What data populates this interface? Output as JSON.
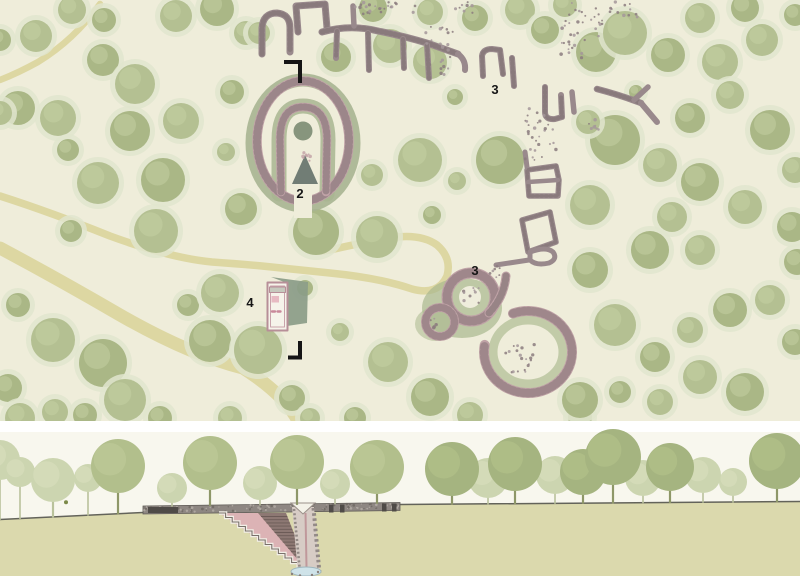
{
  "colors": {
    "plan_bg": "#efedda",
    "path_tan": "#ddd7a2",
    "tree_halo": "#e0e5ce",
    "tree_fill_a": "#b4c092",
    "tree_fill_b": "#aab786",
    "tree_light": "#c6d1a4",
    "stone_grey": "#99898c",
    "stone_pink": "#bfa2a6",
    "stipple_dark": "#7e6f72",
    "label_ink": "#161616",
    "marker_ink": "#151515",
    "section_sky": "#f8f7ee",
    "section_ground": "#dbd9ad",
    "ground_line": "#63635a",
    "cairn_grey": "#8e8782",
    "cairn_dark": "#4f4b47",
    "stair_pink": "#dcb3b5",
    "brick_wall": "#8d7873",
    "brick_line": "#6c5b57",
    "shaft_fill": "#d7ccc5",
    "shaft_stipple": "#938a86",
    "water_blue": "#cfe3e9",
    "figure_olive": "#7c8a49",
    "trunk_dark": "#8e9768",
    "trunk_light": "#b9c29b",
    "canopy_d": "#a5b480",
    "canopy_m": "#b2bf8c",
    "canopy_l": "#ccd5b0"
  },
  "plan": {
    "labels": [
      {
        "t": "2",
        "x": 300,
        "y": 198
      },
      {
        "t": "3",
        "x": 495,
        "y": 94
      },
      {
        "t": "3",
        "x": 475,
        "y": 275
      },
      {
        "t": "4",
        "x": 250,
        "y": 307
      }
    ],
    "markers": [
      "M284,62 L300,62 L300,83",
      "M288,357.5 L300,357.5 L300,341"
    ],
    "paths": [
      {
        "d": "M100,4 Q74,40 38,62 Q18,73 0,80",
        "w": 6.5
      },
      {
        "d": "M0,248 Q60,280 120,315 Q190,355 243,368 Q285,395 298,421",
        "w": 13
      },
      {
        "d": "M0,196 Q50,212 110,236 Q170,258 212,262 Q240,264 262,266 Q300,270 330,273 Q380,278 412,289 Q438,296 447,276 Q452,258 437,245 Q420,233 390,238 Q355,244 330,250 Q310,254 303,242 Q298,232 301,213",
        "w": 7.5
      }
    ],
    "trees": [
      [
        36,
        36,
        16
      ],
      [
        0,
        40,
        11
      ],
      [
        72,
        10,
        14
      ],
      [
        104,
        20,
        12
      ],
      [
        176,
        16,
        16
      ],
      [
        217,
        9,
        17
      ],
      [
        246,
        33,
        12
      ],
      [
        103,
        60,
        16
      ],
      [
        135,
        84,
        20
      ],
      [
        18,
        108,
        17
      ],
      [
        58,
        118,
        18
      ],
      [
        130,
        131,
        20
      ],
      [
        181,
        121,
        18
      ],
      [
        68,
        150,
        11
      ],
      [
        98,
        183,
        21
      ],
      [
        163,
        180,
        22
      ],
      [
        0,
        113,
        12
      ],
      [
        71,
        231,
        11
      ],
      [
        156,
        231,
        22
      ],
      [
        18,
        305,
        12
      ],
      [
        53,
        340,
        22
      ],
      [
        103,
        363,
        24
      ],
      [
        125,
        400,
        21
      ],
      [
        8,
        388,
        14
      ],
      [
        55,
        412,
        13
      ],
      [
        188,
        305,
        11
      ],
      [
        220,
        293,
        19
      ],
      [
        210,
        341,
        21
      ],
      [
        20,
        418,
        15
      ],
      [
        85,
        415,
        12
      ],
      [
        258,
        350,
        24
      ],
      [
        292,
        398,
        13
      ],
      [
        230,
        418,
        12
      ],
      [
        160,
        418,
        12
      ],
      [
        310,
        418,
        10
      ],
      [
        232,
        92,
        12
      ],
      [
        226,
        152,
        9
      ],
      [
        241,
        209,
        16
      ],
      [
        372,
        175,
        11
      ],
      [
        316,
        232,
        23
      ],
      [
        377,
        237,
        21
      ],
      [
        305,
        288,
        8
      ],
      [
        259,
        33,
        11
      ],
      [
        336,
        57,
        15
      ],
      [
        390,
        46,
        17
      ],
      [
        373,
        8,
        14
      ],
      [
        430,
        12,
        13
      ],
      [
        475,
        18,
        13
      ],
      [
        520,
        10,
        15
      ],
      [
        545,
        30,
        14
      ],
      [
        430,
        62,
        17
      ],
      [
        455,
        97,
        8
      ],
      [
        420,
        160,
        22
      ],
      [
        500,
        160,
        24
      ],
      [
        457,
        181,
        9
      ],
      [
        432,
        215,
        9
      ],
      [
        565,
        5,
        12
      ],
      [
        596,
        52,
        20
      ],
      [
        625,
        33,
        22
      ],
      [
        668,
        55,
        17
      ],
      [
        700,
        18,
        15
      ],
      [
        745,
        8,
        14
      ],
      [
        762,
        40,
        16
      ],
      [
        795,
        15,
        11
      ],
      [
        720,
        62,
        18
      ],
      [
        615,
        140,
        25
      ],
      [
        660,
        165,
        17
      ],
      [
        690,
        118,
        15
      ],
      [
        730,
        95,
        14
      ],
      [
        770,
        130,
        20
      ],
      [
        795,
        170,
        13
      ],
      [
        700,
        182,
        19
      ],
      [
        745,
        207,
        17
      ],
      [
        792,
        227,
        15
      ],
      [
        672,
        217,
        15
      ],
      [
        636,
        92,
        7
      ],
      [
        588,
        122,
        12
      ],
      [
        797,
        262,
        13
      ],
      [
        590,
        205,
        20
      ],
      [
        650,
        250,
        19
      ],
      [
        700,
        250,
        15
      ],
      [
        590,
        270,
        18
      ],
      [
        615,
        325,
        21
      ],
      [
        655,
        357,
        15
      ],
      [
        690,
        330,
        13
      ],
      [
        730,
        310,
        17
      ],
      [
        770,
        300,
        15
      ],
      [
        795,
        342,
        13
      ],
      [
        700,
        377,
        17
      ],
      [
        745,
        392,
        19
      ],
      [
        660,
        402,
        13
      ],
      [
        620,
        392,
        11
      ],
      [
        580,
        417,
        12
      ],
      [
        580,
        400,
        18
      ],
      [
        388,
        362,
        20
      ],
      [
        430,
        397,
        19
      ],
      [
        470,
        415,
        13
      ],
      [
        355,
        418,
        11
      ],
      [
        340,
        332,
        9
      ]
    ],
    "shapes": [
      {
        "t": "p",
        "d": "M262,54 L262,28 Q263,13 277,13 Q290,14 290,28 L290,52",
        "s": "#99898c",
        "w": 7,
        "tex": 1
      },
      {
        "t": "p",
        "d": "M298,32 L296,6 L325,4 L327,28",
        "s": "#99898c",
        "w": 7,
        "tex": 1
      },
      {
        "t": "p",
        "d": "M322,32 Q350,24 378,31 Q404,36 430,44 L458,54",
        "s": "#99898c",
        "w": 7,
        "tex": 1
      },
      {
        "t": "p",
        "d": "M337,31 L336,58",
        "s": "#99898c",
        "w": 6,
        "tex": 1
      },
      {
        "t": "p",
        "d": "M368,33 L369,70",
        "s": "#99898c",
        "w": 6,
        "tex": 1
      },
      {
        "t": "p",
        "d": "M403,39 L404,68",
        "s": "#99898c",
        "w": 6,
        "tex": 1
      },
      {
        "t": "p",
        "d": "M427,45 L429,78",
        "s": "#99898c",
        "w": 6,
        "tex": 1
      },
      {
        "t": "p",
        "d": "M354,26 L353,6",
        "s": "#99898c",
        "w": 5.5
      },
      {
        "t": "p",
        "d": "M458,54 Q466,60 465,70",
        "s": "#99898c",
        "w": 6
      },
      {
        "t": "p",
        "d": "M483,76 L482,56 Q483,49 492,49 L500,50 L503,74",
        "s": "#99898c",
        "w": 6,
        "tex": 1
      },
      {
        "t": "p",
        "d": "M512,58 L514,86",
        "s": "#99898c",
        "w": 6,
        "tex": 1
      },
      {
        "t": "p",
        "d": "M545,87 L545,112 Q545,120 555,119 L562,117 L561,95",
        "s": "#99898c",
        "w": 6,
        "tex": 1
      },
      {
        "t": "p",
        "d": "M572,92 L574,112",
        "s": "#99898c",
        "w": 5.5
      },
      {
        "t": "p",
        "d": "M597,89 Q620,95 641,103",
        "s": "#99898c",
        "w": 6.5,
        "tex": 1
      },
      {
        "t": "p",
        "d": "M641,103 L657,122",
        "s": "#99898c",
        "w": 6
      },
      {
        "t": "p",
        "d": "M634,100 L648,87",
        "s": "#99898c",
        "w": 5.5
      },
      {
        "t": "p",
        "d": "M525,152 L527,167",
        "s": "#99898c",
        "w": 5
      },
      {
        "t": "p",
        "d": "M529,196 L527,170 L556,166 L559,180 L558,196 Z",
        "s": "#99898c",
        "w": 5.5,
        "tex": 1
      },
      {
        "t": "p",
        "d": "M528,182 L558,180",
        "s": "#99898c",
        "w": 4.5
      },
      {
        "t": "p",
        "d": "M522,220 L550,212 L556,242 L528,252 Z",
        "s": "#99898c",
        "w": 5.5,
        "tex": 1
      },
      {
        "t": "p",
        "d": "M530,252 Q546,246 553,252 Q558,259 549,263 Q536,266 530,260 Z",
        "s": "#99898c",
        "w": 5
      },
      {
        "t": "p",
        "d": "M496,265 L529,260",
        "s": "#99898c",
        "w": 5
      },
      {
        "t": "e",
        "cx": 303,
        "cy": 143,
        "rx": 51,
        "ry": 63,
        "s": "#a7b491",
        "w": 13,
        "o": 0.9
      },
      {
        "t": "p",
        "d": "M279,194 L279,140 Q279,106 303,106 Q328,106 328,140 L327,194",
        "s": "#a8b591",
        "w": 15,
        "o": 0.85
      },
      {
        "t": "e",
        "cx": 303,
        "cy": 141,
        "rx": 46,
        "ry": 60,
        "s": "#c0a3a7",
        "w": 9.5
      },
      {
        "t": "e",
        "cx": 303,
        "cy": 141,
        "rx": 46,
        "ry": 60,
        "s": "#8d797d",
        "w": 8,
        "da": "1.6 3.4",
        "o": 0.7
      },
      {
        "t": "p",
        "d": "M294,192 h18 v26 h-18 Z",
        "f": "#efedda"
      },
      {
        "t": "p",
        "d": "M281,192 L280,140 Q280,107 303,107 Q327,107 327,140 L326,192",
        "s": "#c0a3a7",
        "w": 8.5
      },
      {
        "t": "p",
        "d": "M281,192 L280,140 Q280,107 303,107 Q327,107 327,140 L326,192",
        "s": "#8d797d",
        "w": 7,
        "da": "1.5 3",
        "o": 0.7
      },
      {
        "t": "c",
        "cx": 303,
        "cy": 131,
        "r": 9.5,
        "f": "#87957d"
      },
      {
        "t": "p",
        "d": "M305,155 L318,184 L292,184 Z",
        "f": "#717d75"
      },
      {
        "t": "e",
        "cx": 462,
        "cy": 308,
        "rx": 40,
        "ry": 30,
        "f": "#a9b88e",
        "o": 0.7
      },
      {
        "t": "e",
        "cx": 436,
        "cy": 324,
        "rx": 21,
        "ry": 17,
        "f": "#a9b88e",
        "o": 0.55
      },
      {
        "t": "c",
        "cx": 471,
        "cy": 297,
        "r": 24,
        "s": "#bfa2a6",
        "w": 11
      },
      {
        "t": "c",
        "cx": 471,
        "cy": 297,
        "r": 24,
        "s": "#8d797d",
        "w": 9,
        "da": "1.6 3.2",
        "o": 0.65
      },
      {
        "t": "c",
        "cx": 440,
        "cy": 322,
        "r": 14.5,
        "s": "#bfa2a6",
        "w": 9
      },
      {
        "t": "c",
        "cx": 440,
        "cy": 322,
        "r": 14.5,
        "s": "#8d797d",
        "w": 7.5,
        "da": "1.5 3",
        "o": 0.65
      },
      {
        "t": "c",
        "cx": 470,
        "cy": 297,
        "r": 11,
        "f": "#efeddc"
      },
      {
        "t": "p",
        "d": "M489,313 Q504,297 506,276",
        "s": "#bfa2a6",
        "w": 9,
        "tex": 1
      },
      {
        "t": "e",
        "cx": 528,
        "cy": 352,
        "rx": 35,
        "ry": 32,
        "s": "#a9b88e",
        "w": 9,
        "o": 0.65
      },
      {
        "t": "p",
        "d": "M513,313.5 A44,41 0 1 1 484.7,344.9",
        "s": "#bfa2a6",
        "w": 10
      },
      {
        "t": "p",
        "d": "M513,313.5 A44,41 0 1 1 484.7,344.9",
        "s": "#8d797d",
        "w": 8.5,
        "da": "1.7 3.4",
        "o": 0.65
      },
      {
        "t": "p",
        "d": "M271,277 L308,282 L307,323 L287,326 L287,283 Z",
        "f": "#8b9c88",
        "o": 0.92
      },
      {
        "t": "p",
        "d": "M267.5,282.5 h20 v48 h-20 Z",
        "f": "#f6f3ea",
        "s": "#b78f98",
        "w": 2
      },
      {
        "t": "p",
        "d": "M270.5,286 h14 v41 h-14 Z",
        "s": "#c9a3ab",
        "w": 1
      },
      {
        "t": "p",
        "d": "M269.5,287 h16 v5.5 h-16 Z",
        "f": "#c6c9bd",
        "s": "#b78f98",
        "w": 1
      },
      {
        "t": "p",
        "d": "M271.5,296 h7.5 v6.5 h-7.5 Z",
        "f": "#e7bac2"
      },
      {
        "t": "p",
        "d": "M272,311.5 h3 M277.5,311.5 h3",
        "s": "#c9889a",
        "w": 2.4
      }
    ],
    "rubble": [
      [
        352,
        2,
        66,
        12,
        24,
        0
      ],
      [
        425,
        25,
        35,
        50,
        26,
        0
      ],
      [
        556,
        2,
        48,
        36,
        26,
        0
      ],
      [
        610,
        2,
        32,
        20,
        12,
        0
      ],
      [
        525,
        108,
        32,
        52,
        30,
        0
      ],
      [
        455,
        2,
        18,
        12,
        8,
        0
      ],
      [
        560,
        40,
        26,
        18,
        12,
        0
      ],
      [
        585,
        118,
        16,
        12,
        7,
        0
      ],
      [
        462,
        288,
        17,
        15,
        9,
        0
      ],
      [
        505,
        342,
        30,
        32,
        20,
        0
      ],
      [
        486,
        266,
        14,
        12,
        7,
        0
      ],
      [
        300,
        152,
        14,
        16,
        8,
        1
      ],
      [
        428,
        316,
        12,
        12,
        6,
        0
      ]
    ]
  },
  "divider": {
    "y": 421,
    "h": 11
  },
  "section": {
    "groundPts": [
      [
        0,
        519.5
      ],
      [
        143,
        512.5
      ],
      [
        400,
        504.5
      ],
      [
        800,
        501.5
      ]
    ],
    "band": {
      "pts": [
        [
          143,
          514
        ],
        [
          143,
          506
        ],
        [
          400,
          502.5
        ],
        [
          400,
          510.5
        ]
      ],
      "topLeft": 506,
      "topRight": 502.5,
      "x0": 143,
      "x1": 400,
      "thick": 7.5,
      "speckles": 120,
      "blocks": [
        [
          148,
          507,
          30,
          6
        ],
        [
          329,
          504.5,
          4.5,
          8
        ],
        [
          340,
          504.5,
          4.5,
          8
        ],
        [
          382,
          503.5,
          4.5,
          8
        ],
        [
          392,
          503.5,
          4.5,
          8
        ]
      ]
    },
    "excavation": {
      "pink": [
        [
          219,
          513
        ],
        [
          286,
          513
        ],
        [
          310,
          574
        ]
      ],
      "brick": [
        [
          258,
          513
        ],
        [
          286,
          513
        ],
        [
          310,
          574
        ]
      ],
      "hatch": {
        "y0": 516.5,
        "y1": 571,
        "step": 3.2,
        "xl0": 258,
        "kl": 0.852,
        "xr0": 286,
        "kr": 0.393,
        "yb": 513
      },
      "steps": {
        "x": 219,
        "y": 513,
        "n": 13,
        "dx": 6.6,
        "dy": 4.5
      },
      "shaft": [
        [
          292,
          507
        ],
        [
          314,
          507
        ],
        [
          320,
          574
        ],
        [
          298,
          574
        ]
      ],
      "shaftEdges": [
        {
          "d": "M294,509 L300,572",
          "w": 2.6,
          "da": "2 2.3"
        },
        {
          "d": "M313.5,508 L319.5,573",
          "w": 4,
          "da": "2.6 2.6"
        }
      ],
      "centerLine": "M305.5,513 L306.5,567",
      "notch": [
        [
          291,
          503
        ],
        [
          315,
          503
        ],
        [
          303,
          514
        ]
      ],
      "water": {
        "cx": 306,
        "cy": 571.5,
        "rx": 15,
        "ry": 4.5
      },
      "waterDots": [
        [
          292,
          574
        ],
        [
          318,
          572
        ],
        [
          300,
          575.5
        ],
        [
          312,
          575
        ]
      ]
    },
    "trees": [
      [
        0,
        460,
        20,
        "l"
      ],
      [
        20,
        472,
        15,
        "l"
      ],
      [
        88,
        478,
        14,
        "l"
      ],
      [
        53,
        480,
        22,
        "l"
      ],
      [
        172,
        488,
        15,
        "l"
      ],
      [
        260,
        483,
        17,
        "l"
      ],
      [
        335,
        484,
        15,
        "l"
      ],
      [
        488,
        478,
        20,
        "l"
      ],
      [
        555,
        475,
        19,
        "l"
      ],
      [
        643,
        478,
        18,
        "l"
      ],
      [
        703,
        475,
        18,
        "l"
      ],
      [
        733,
        482,
        14,
        "l"
      ],
      [
        118,
        466,
        27,
        "m"
      ],
      [
        210,
        463,
        27,
        "m"
      ],
      [
        297,
        462,
        27,
        "m"
      ],
      [
        377,
        467,
        27,
        "m"
      ],
      [
        452,
        469,
        27,
        "d"
      ],
      [
        515,
        464,
        27,
        "d"
      ],
      [
        583,
        472,
        23,
        "d"
      ],
      [
        613,
        457,
        28,
        "d"
      ],
      [
        670,
        467,
        24,
        "d"
      ],
      [
        777,
        461,
        28,
        "d"
      ]
    ],
    "figure": {
      "x": 66
    }
  }
}
